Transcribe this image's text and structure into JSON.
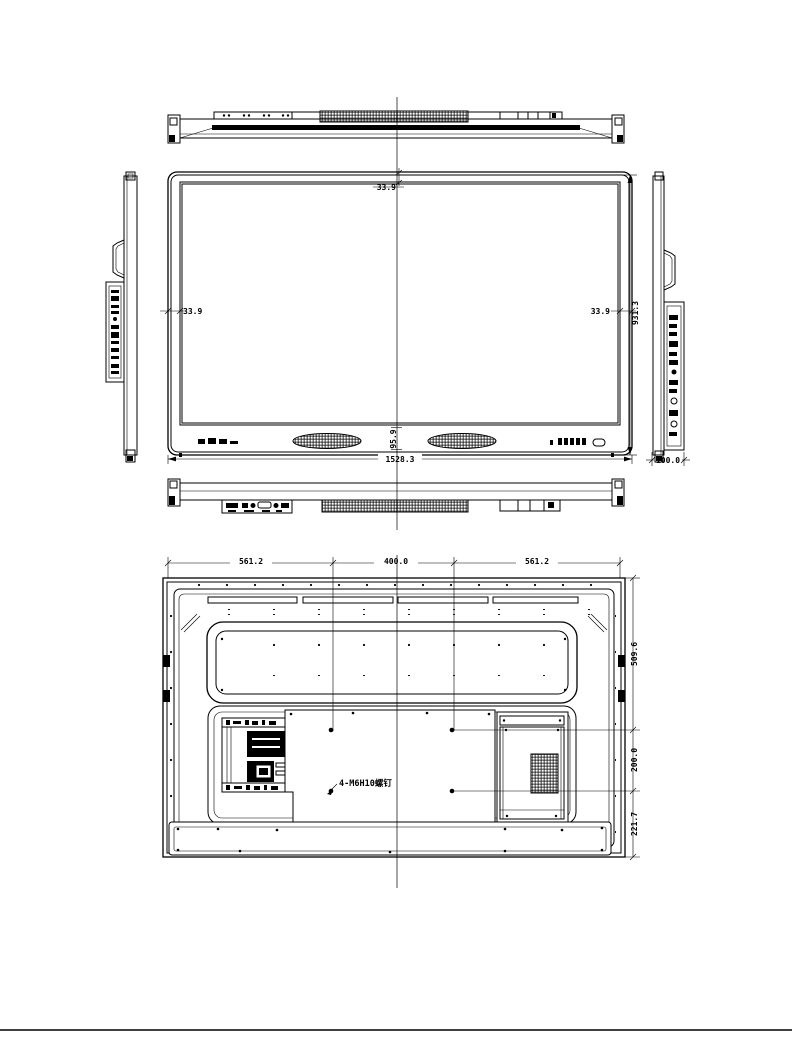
{
  "drawing": {
    "front_view": {
      "dims": {
        "top_bezel": "33.9",
        "left_bezel": "33.9",
        "right_bezel": "33.9",
        "overall_height": "931.3",
        "overall_width": "1528.3",
        "bottom_bezel": "95.9"
      }
    },
    "side_view": {
      "dims": {
        "depth": "100.0"
      }
    },
    "rear_view": {
      "dims": {
        "top_left_span": "561.2",
        "vesa_horizontal": "400.0",
        "top_right_span": "561.2",
        "top_to_upper_holes": "509.6",
        "vesa_vertical": "200.0",
        "lower_holes_to_bottom": "221.7"
      },
      "annotations": {
        "vesa_screw_note": "4-M6H10螺钉"
      }
    }
  }
}
